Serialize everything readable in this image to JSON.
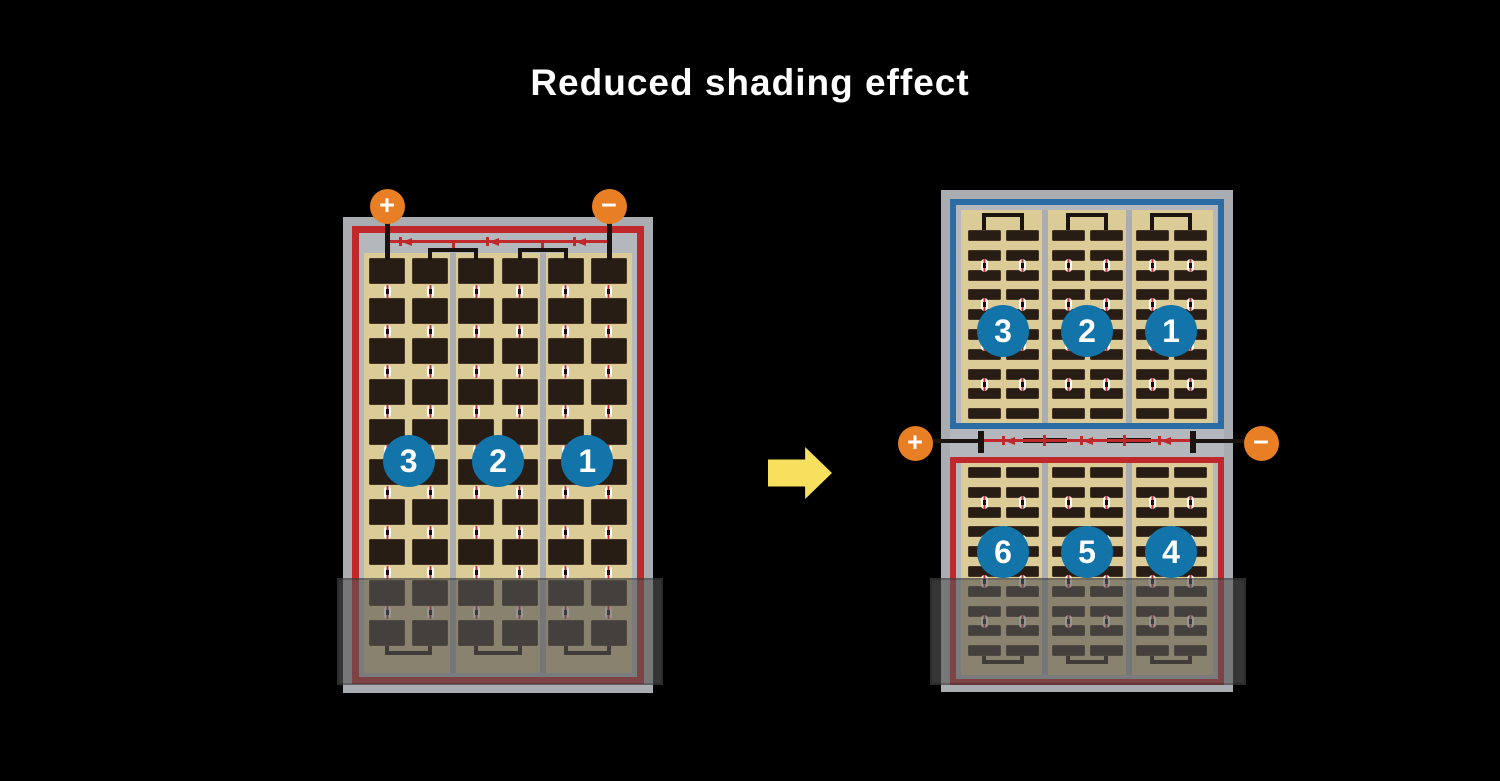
{
  "title": "Reduced shading effect",
  "colors": {
    "background": "#000000",
    "title_text": "#ffffff",
    "frame_gray": "#a9adb2",
    "mat_gray": "#b4b7bb",
    "panel_tan": "#dacb97",
    "cell_brown": "#271d15",
    "circuit_red": "#c0282c",
    "circuit_blue": "#2b6ca4",
    "busbar_black": "#1b130d",
    "terminal_orange": "#e87f25",
    "number_badge_blue": "#1274a8",
    "arrow_yellow": "#f8e05f",
    "connector_red": "#c03030",
    "shade": "rgba(85,85,85,0.62)"
  },
  "left_panel": {
    "terminals": {
      "positive": "+",
      "negative": "−"
    },
    "cell_strings": [
      {
        "label": "3"
      },
      {
        "label": "2"
      },
      {
        "label": "1"
      }
    ],
    "grid": {
      "sections": 3,
      "columns_per_section": 2,
      "rows": 10,
      "cell_type": "full-cell"
    },
    "bypass_diodes": 3
  },
  "right_panel": {
    "terminals": {
      "positive": "+",
      "negative": "−"
    },
    "top_cell_strings": [
      {
        "label": "3"
      },
      {
        "label": "2"
      },
      {
        "label": "1"
      }
    ],
    "bottom_cell_strings": [
      {
        "label": "6"
      },
      {
        "label": "5"
      },
      {
        "label": "4"
      }
    ],
    "grid": {
      "sections": 3,
      "columns_per_section": 2,
      "rows_per_half": 10,
      "cell_type": "half-cut"
    },
    "bypass_diodes": 3
  },
  "arrow": {
    "direction": "right"
  }
}
